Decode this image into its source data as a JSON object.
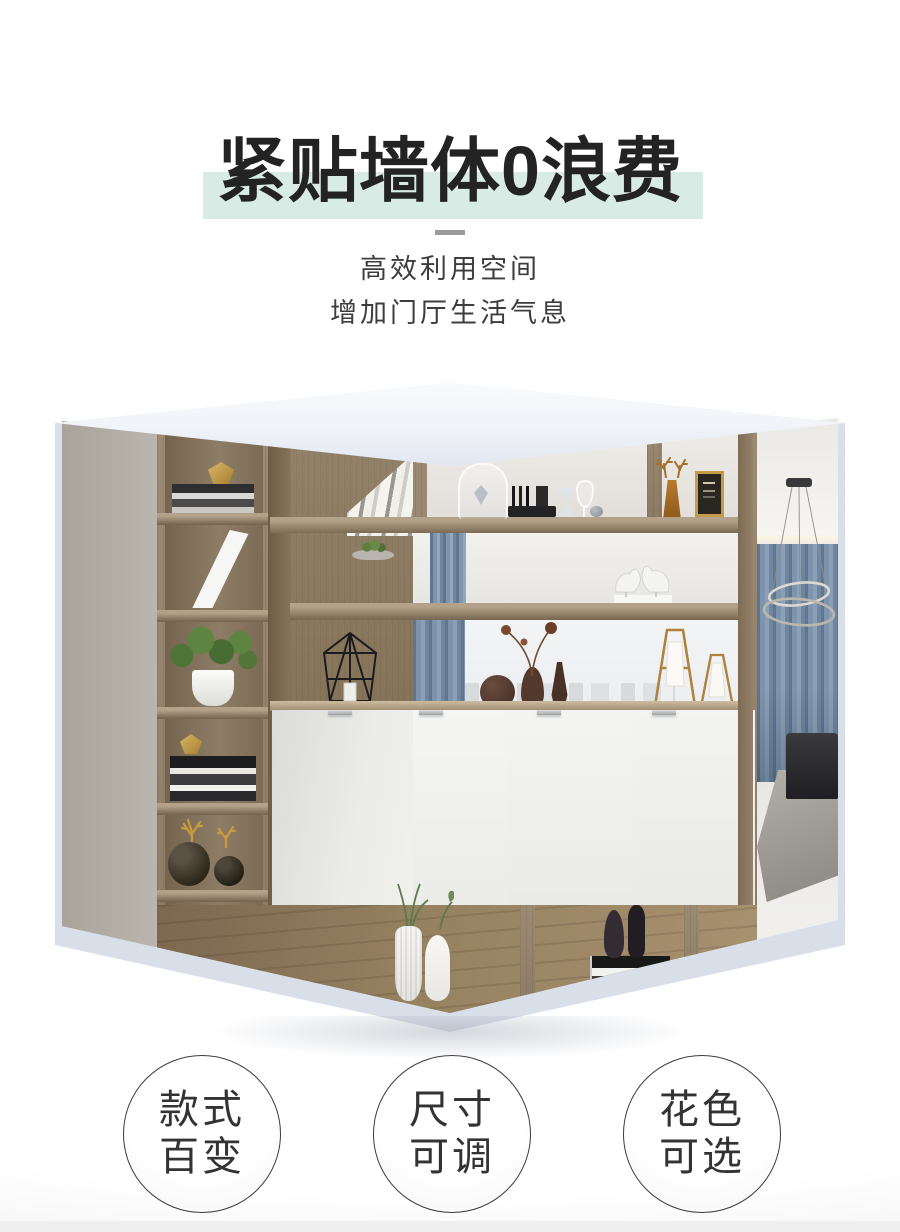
{
  "header": {
    "title": "紧贴墙体0浪费",
    "subtitle_line1": "高效利用空间",
    "subtitle_line2": "增加门厅生活气息"
  },
  "hero_image": {
    "alt": "转角玄关柜实景图：木纹开放格展示柜搭配白色柜门，格内摆放书本、绿植、花瓶、小鹿摆件与烛台，背景为客厅蓝色窗帘、环形吊灯、黑色沙发与灰色地毯"
  },
  "features": [
    {
      "line1": "款式",
      "line2": "百变"
    },
    {
      "line1": "尺寸",
      "line2": "可调"
    },
    {
      "line1": "花色",
      "line2": "可选"
    }
  ],
  "colors": {
    "title_highlight": "#d9ebe5",
    "divider": "#9b9b9b",
    "backdrop": "#d9dfe9",
    "lid": "#f0f3f8",
    "wood": "#94826a",
    "curtain_blue": "#7e94ac",
    "door_white": "#f3f3f1",
    "bottom_strip": "#efefef"
  }
}
